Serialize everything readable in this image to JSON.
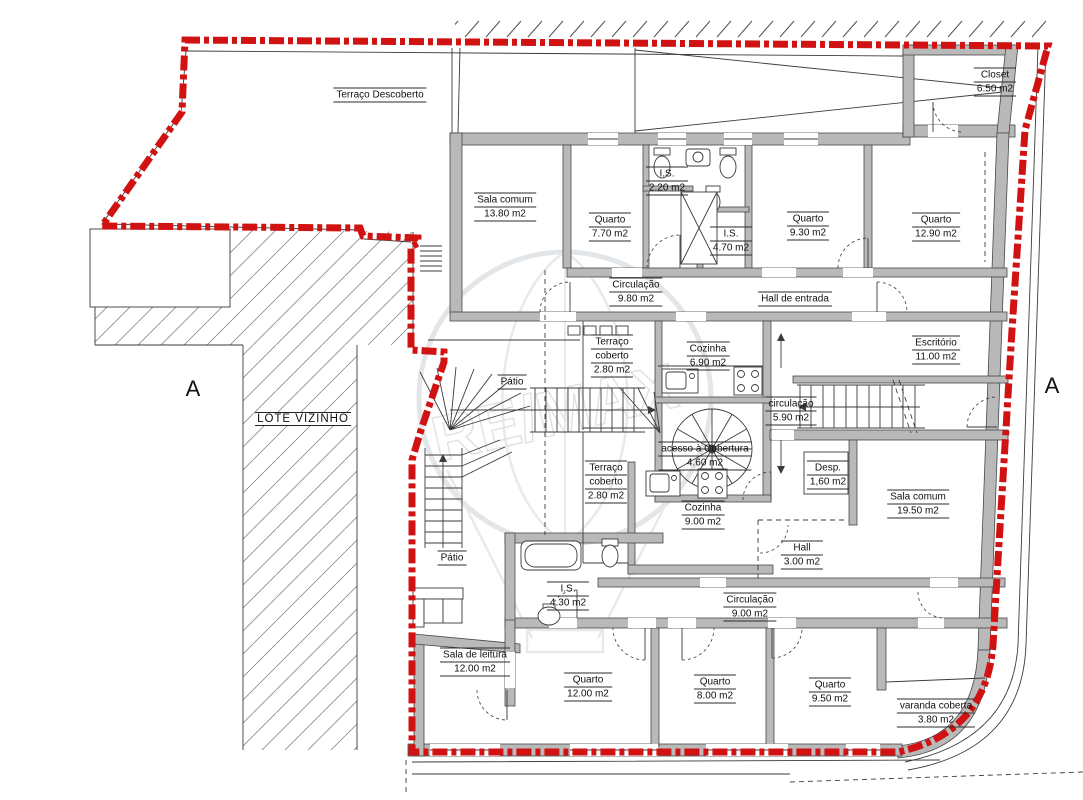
{
  "colors": {
    "boundary_red": "#d01212",
    "wall_gray": "#b9b9b9",
    "line_dark": "#3b3b3b",
    "hatch_gray": "#8e8e8e",
    "watermark_gray": "#c3c8cd"
  },
  "section_markers": {
    "left": "A",
    "right": "A"
  },
  "neighbor_label": "LOTE VIZINHO",
  "watermark": {
    "text": "RE/MAX"
  },
  "rooms": [
    {
      "n1": "Terraço Descoberto"
    },
    {
      "n1": "Closet",
      "area": "6.50 m2"
    },
    {
      "n1": "Sala comum",
      "area": "13.80 m2"
    },
    {
      "n1": "Quarto",
      "area": "7.70 m2"
    },
    {
      "n1": "I.S.",
      "area": "2.20 m2"
    },
    {
      "n1": "I.S.",
      "area": "4.70 m2"
    },
    {
      "n1": "Quarto",
      "area": "9.30 m2"
    },
    {
      "n1": "Quarto",
      "area": "12.90 m2"
    },
    {
      "n1": "Circulação",
      "area": "9.80 m2"
    },
    {
      "n1": "Hall de entrada"
    },
    {
      "n1": "Terraço",
      "n2": "coberto",
      "area": "2.80 m2"
    },
    {
      "n1": "Cozinha",
      "area": "6.90 m2"
    },
    {
      "n1": "Escritório",
      "area": "11.00 m2"
    },
    {
      "n1": "Pátio"
    },
    {
      "n1": "circulação",
      "area": "5.90 m2"
    },
    {
      "n1": "acesso à Cobertura",
      "area": "4.60 m2"
    },
    {
      "n1": "Desp.",
      "area": "1,60 m2"
    },
    {
      "n1": "Terraço",
      "n2": "coberto",
      "area": "2.80 m2"
    },
    {
      "n1": "Cozinha",
      "area": "9.00 m2"
    },
    {
      "n1": "Sala comum",
      "area": "19.50 m2"
    },
    {
      "n1": "Pátio"
    },
    {
      "n1": "Hall",
      "area": "3.00 m2"
    },
    {
      "n1": "I.S.",
      "area": "4.30 m2"
    },
    {
      "n1": "Circulação",
      "area": "9.00 m2"
    },
    {
      "n1": "Sala de leitura",
      "area": "12.00 m2"
    },
    {
      "n1": "Quarto",
      "area": "12.00 m2"
    },
    {
      "n1": "Quarto",
      "area": "8.00 m2"
    },
    {
      "n1": "Quarto",
      "area": "9.50 m2"
    },
    {
      "n1": "varanda coberta",
      "area": "3.80 m2"
    }
  ]
}
